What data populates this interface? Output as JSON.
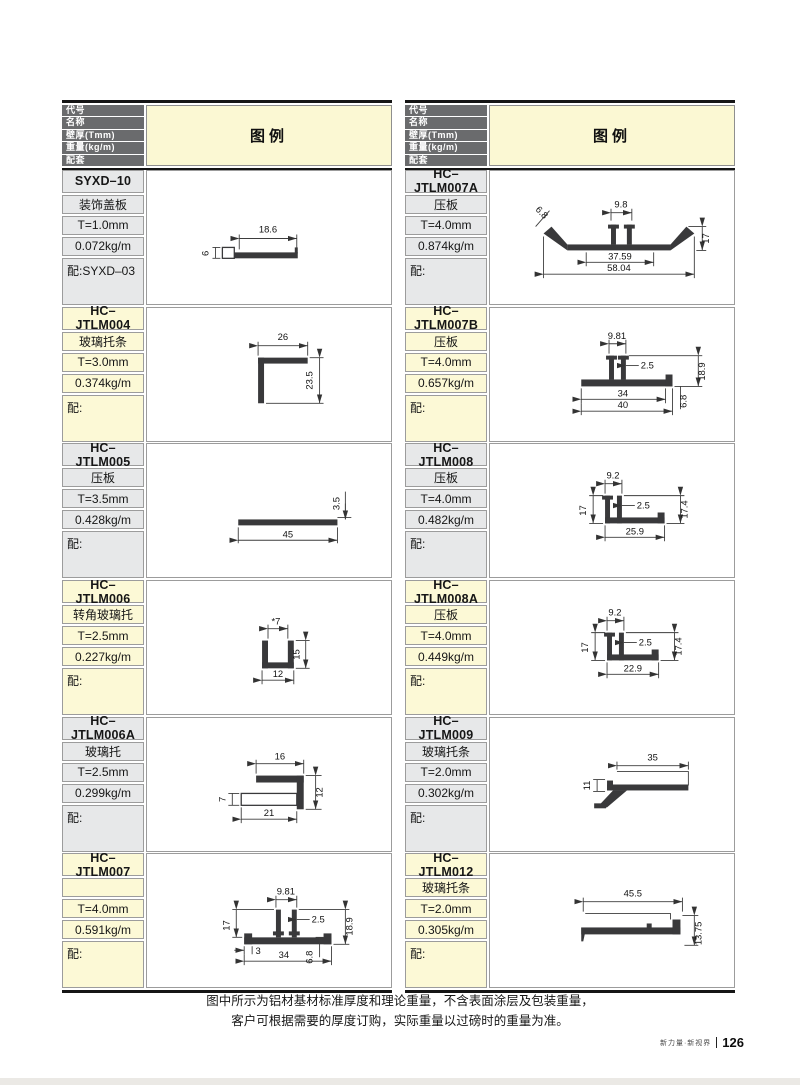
{
  "header": {
    "row_labels": [
      "代号",
      "名称",
      "壁厚(Tmm)",
      "重量(kg/m)",
      "配套"
    ],
    "legend_label": "图例"
  },
  "blocks": [
    {
      "code": "SYXD–10",
      "name": "装饰盖板",
      "thickness": "T=1.0mm",
      "weight": "0.072kg/m",
      "match": "配:SYXD–03",
      "dims": [
        "18.6",
        "6"
      ]
    },
    {
      "code": "HC–JTLM004",
      "name": "玻璃托条",
      "thickness": "T=3.0mm",
      "weight": "0.374kg/m",
      "match": "配:",
      "dims": [
        "26",
        "23.5"
      ]
    },
    {
      "code": "HC–JTLM005",
      "name": "压板",
      "thickness": "T=3.5mm",
      "weight": "0.428kg/m",
      "match": "配:",
      "dims": [
        "3.5",
        "45"
      ]
    },
    {
      "code": "HC–JTLM006",
      "name": "转角玻璃托",
      "thickness": "T=2.5mm",
      "weight": "0.227kg/m",
      "match": "配:",
      "dims": [
        "*7",
        "15",
        "12"
      ]
    },
    {
      "code": "HC–JTLM006A",
      "name": "玻璃托",
      "thickness": "T=2.5mm",
      "weight": "0.299kg/m",
      "match": "配:",
      "dims": [
        "16",
        "7",
        "12",
        "21"
      ]
    },
    {
      "code": "HC–JTLM007",
      "name": "",
      "thickness": "T=4.0mm",
      "weight": "0.591kg/m",
      "match": "配:",
      "dims": [
        "9.81",
        "2.5",
        "17",
        "18.9",
        "3",
        "34",
        "6.8"
      ]
    },
    {
      "code": "HC–JTLM007A",
      "name": "压板",
      "thickness": "T=4.0mm",
      "weight": "0.874kg/m",
      "match": "配:",
      "dims": [
        "6.8",
        "9.8",
        "17",
        "37.59",
        "58.04"
      ]
    },
    {
      "code": "HC–JTLM007B",
      "name": "压板",
      "thickness": "T=4.0mm",
      "weight": "0.657kg/m",
      "match": "配:",
      "dims": [
        "9.81",
        "2.5",
        "18.9",
        "34",
        "40",
        "6.8"
      ]
    },
    {
      "code": "HC–JTLM008",
      "name": "压板",
      "thickness": "T=4.0mm",
      "weight": "0.482kg/m",
      "match": "配:",
      "dims": [
        "9.2",
        "17",
        "2.5",
        "17.4",
        "25.9"
      ]
    },
    {
      "code": "HC–JTLM008A",
      "name": "压板",
      "thickness": "T=4.0mm",
      "weight": "0.449kg/m",
      "match": "配:",
      "dims": [
        "9.2",
        "17",
        "2.5",
        "17.4",
        "22.9"
      ]
    },
    {
      "code": "HC–JTLM009",
      "name": "玻璃托条",
      "thickness": "T=2.0mm",
      "weight": "0.302kg/m",
      "match": "配:",
      "dims": [
        "35",
        "11"
      ]
    },
    {
      "code": "HC–JTLM012",
      "name": "玻璃托条",
      "thickness": "T=2.0mm",
      "weight": "0.305kg/m",
      "match": "配:",
      "dims": [
        "45.5",
        "13.75"
      ]
    }
  ],
  "footer": {
    "note1": "图中所示为铝材基材标准厚度和理论重量，不含表面涂层及包装重量，",
    "note2": "客户可根据需要的厚度订购，实际重量以过磅时的重量为准。",
    "brand": "新力量·新视界",
    "page_number": "126"
  },
  "colors": {
    "header_bg": "#6a6b6d",
    "legend_bg": "#fbf8d3",
    "cell_gray": "#e7e8e9",
    "cell_yellow": "#fcf9d6",
    "profile": "#39393b",
    "border_dark": "#151515"
  }
}
